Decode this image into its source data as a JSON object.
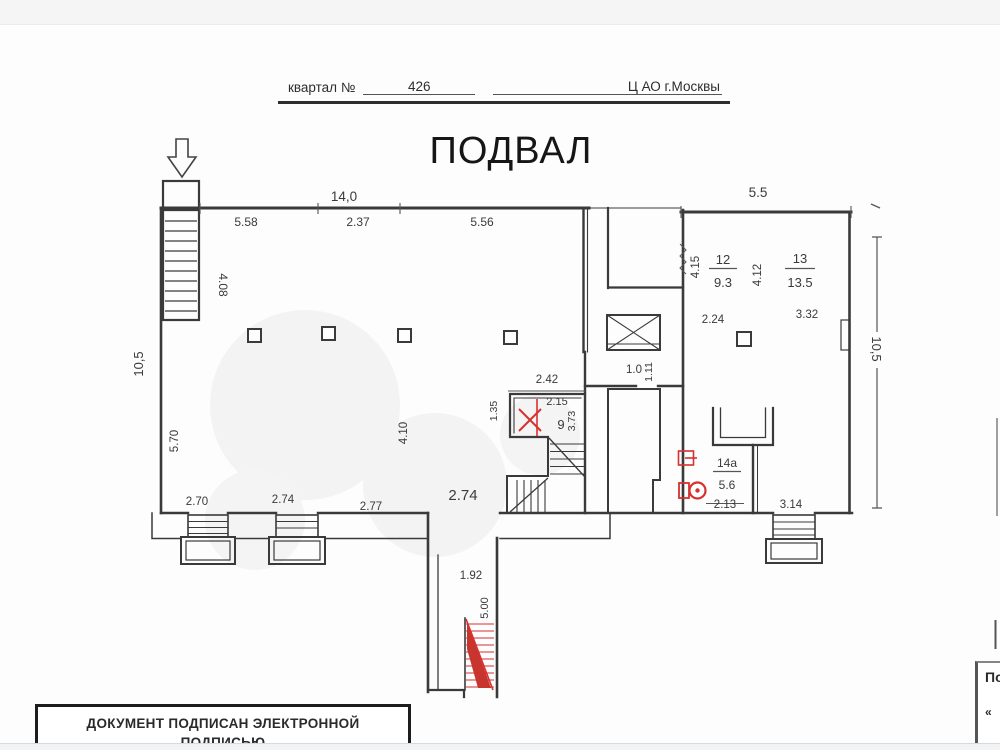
{
  "header": {
    "quarter_label": "квартал №",
    "quarter_number": "426",
    "district": "Ц АО г.Москвы"
  },
  "title": "ПОДВАЛ",
  "labels": {
    "total_width": "14,0",
    "seg_a": "5.58",
    "seg_b": "2.37",
    "seg_c": "5.56",
    "right_width": "5.5",
    "left_height": "10,5",
    "right_height": "10,5",
    "stair_len": "4.08",
    "hall_left": "5.70",
    "hall_depth": "4.10",
    "ent_a": "2.70",
    "ent_b": "2.74",
    "ent_c": "2.77",
    "ent_d": "2.74",
    "r9_top": "2.42",
    "r9_left": "1.35",
    "r9_w": "2.15",
    "r9_num": "9",
    "r9_h": "3.73",
    "lift_w": "1.0",
    "lift_h": "1.11",
    "r12_h": "4.15",
    "r12_num": "12",
    "r12_area": "9.3",
    "r13_h": "4.12",
    "r13_num": "13",
    "r13_area": "13.5",
    "r12_w": "2.24",
    "r13_w": "3.32",
    "r14a_num": "14а",
    "r14a_area": "5.6",
    "r14a_w": "2.13",
    "r14a_right": "3.14",
    "well_w": "1.92",
    "well_len": "5.00"
  },
  "signature": {
    "line1": "ДОКУМЕНТ ПОДПИСАН ЭЛЕКТРОННОЙ",
    "line2": "ПОДПИСЬЮ"
  },
  "corner": {
    "text": "По",
    "quote": "«"
  },
  "colors": {
    "wall": "#3a3a3a",
    "dim": "#4a4a4a",
    "red": "#d8302f"
  }
}
